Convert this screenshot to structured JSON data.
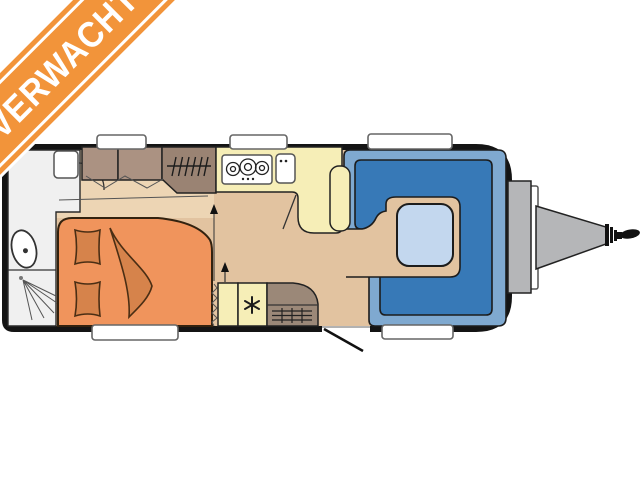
{
  "banner": {
    "label": "VERWACHT"
  },
  "floorplan": {
    "type": "caravan-top-view",
    "zones": [
      "bathroom-with-shower-and-toilet",
      "french-bed",
      "wardrobe",
      "kitchen-with-3-burner-stove-and-sink",
      "fridge",
      "heater",
      "entry-door",
      "u-shaped-dinette-with-table",
      "drawbar-hitch"
    ],
    "window_count": 5
  },
  "colors": {
    "banner": "#f2943a",
    "bodyBlack": "#141414",
    "floor": "#e2c3a0",
    "floorLight": "#edd5b4",
    "bathroom": "#f0f0f0",
    "bed": "#f0945c",
    "bedding": "#d6834b",
    "cabinet": "#ab9282",
    "wardrobe": "#9a8373",
    "kitchen": "#f6eeb7",
    "heater": "#9b8878",
    "seatDark": "#3779b7",
    "seatLight": "#7fa9d0",
    "table": "#c3d7ee",
    "metal": "#b5b6b8"
  }
}
